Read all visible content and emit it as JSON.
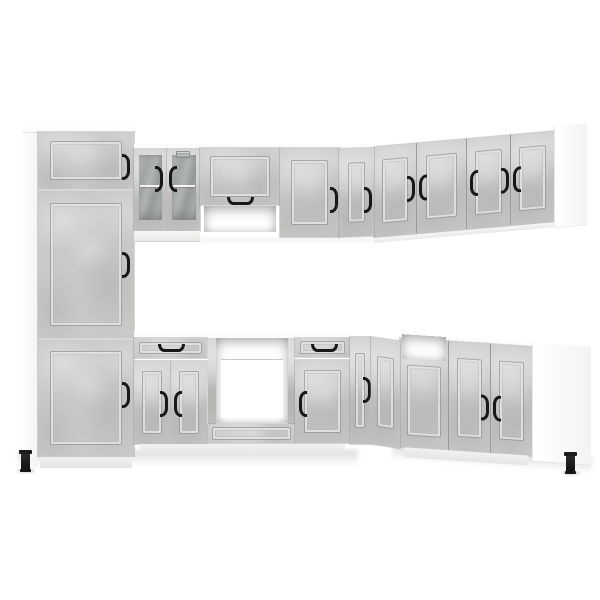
{
  "meta": {
    "description": "Product photo: L-shaped modular kitchen cabinet set in concrete grey with black bow handles, shown on a plain white background"
  },
  "colors": {
    "background": "#ffffff",
    "concrete": "#c9cac8",
    "concrete_light": "#d8d9d7",
    "concrete_dark": "#b9bab8",
    "panel_line": "#a7a8a6",
    "carcass_white": "#fbfbfa",
    "glass": "#a4a8a4",
    "handle_black": "#181818",
    "floor_shadow": "#dcdcda"
  },
  "scene": {
    "finish_name": "concrete grey",
    "carcass_finish": "white",
    "layout": "L-shaped, left run front-facing, right run receding",
    "visible_feet": 2,
    "visible_handles": 21,
    "units": [
      {
        "name": "tall-pantry-cabinet",
        "position": "far left",
        "doors": 3,
        "handle_side": "right"
      },
      {
        "name": "wall-glass-cabinet",
        "doors": 2,
        "glass_panes": 2,
        "shelf_visible": true,
        "vent_grille": true
      },
      {
        "name": "wall-flip-door-cabinet",
        "doors": 1,
        "handle": "horizontal bottom",
        "open_niche_below": true
      },
      {
        "name": "wall-single-door-cabinet",
        "doors": 1
      },
      {
        "name": "wall-corner-cabinet",
        "doors": 2
      },
      {
        "name": "wall-run-right",
        "doors": 4,
        "end_panel": "white"
      },
      {
        "name": "base-drawer-cabinet",
        "drawers": 1,
        "doors": 2
      },
      {
        "name": "base-oven-cabinet",
        "open_bay": true,
        "bottom_drawer": true
      },
      {
        "name": "base-drawer-door-cabinet",
        "drawers": 1,
        "doors": 1
      },
      {
        "name": "base-corner-cabinet",
        "doors": 2
      },
      {
        "name": "base-sink-cabinet",
        "open_top": true,
        "front_panel": 1
      },
      {
        "name": "base-double-door-cabinet",
        "doors": 2,
        "end_panel": "white"
      }
    ]
  }
}
